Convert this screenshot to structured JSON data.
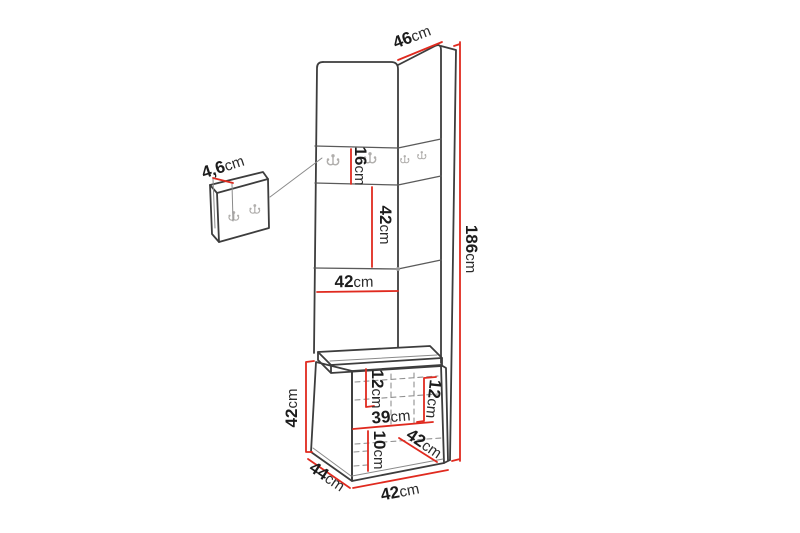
{
  "diagram": {
    "type": "furniture dimension diagram",
    "subject": "corner hallway set with hook panels and bench",
    "unit": "cm",
    "colors": {
      "dimension_red": "#e02a1f",
      "outline_gray": "#3d3d3d",
      "hook_gray": "#b0aeac",
      "background": "#ffffff",
      "text": "#1c1c1c"
    },
    "dimensions": {
      "top_depth": {
        "value": "46",
        "unit": "cm"
      },
      "hook_panel_thickness": {
        "value": "4,6",
        "unit": "cm"
      },
      "hook_strip_height": {
        "value": "16",
        "unit": "cm"
      },
      "middle_section_height": {
        "value": "42",
        "unit": "cm"
      },
      "panel_width": {
        "value": "42",
        "unit": "cm"
      },
      "total_height": {
        "value": "186",
        "unit": "cm"
      },
      "bench_height": {
        "value": "42",
        "unit": "cm"
      },
      "cushion_height_left": {
        "value": "12",
        "unit": "cm"
      },
      "cushion_height_right": {
        "value": "12",
        "unit": "cm"
      },
      "bench_inner_width": {
        "value": "39",
        "unit": "cm"
      },
      "base_height": {
        "value": "10",
        "unit": "cm"
      },
      "seat_depth": {
        "value": "42",
        "unit": "cm"
      },
      "bench_depth": {
        "value": "44",
        "unit": "cm"
      },
      "bench_width": {
        "value": "42",
        "unit": "cm"
      }
    }
  }
}
